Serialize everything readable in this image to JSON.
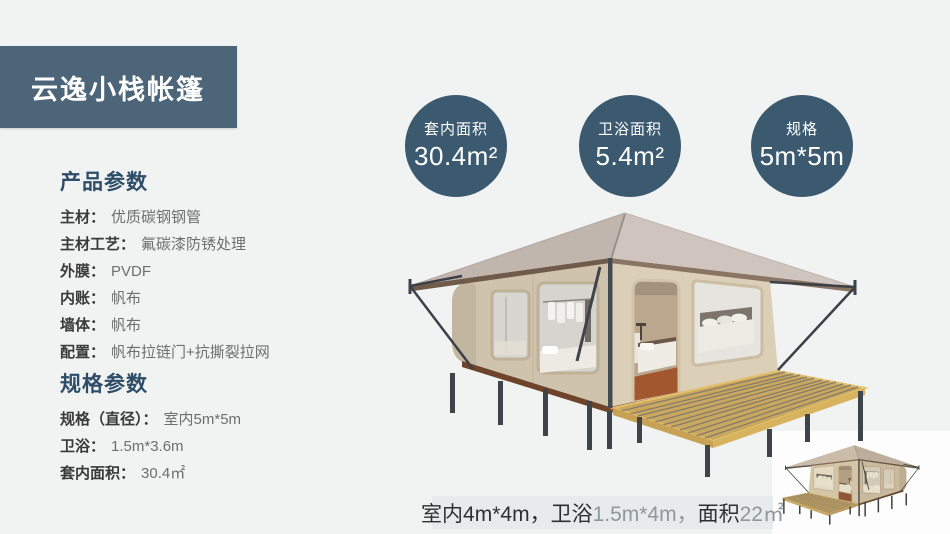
{
  "title": "云逸小栈帐篷",
  "colors": {
    "banner_bg": "#4d6579",
    "stat_circle_bg": "#3b5a70",
    "heading_text": "#2e4d68",
    "page_bg": "#f1f2f2"
  },
  "sections": [
    {
      "heading": "产品参数",
      "items": [
        {
          "label": "主材：",
          "value": "优质碳钢钢管"
        },
        {
          "label": "主材工艺：",
          "value": "氟碳漆防锈处理"
        },
        {
          "label": "外膜：",
          "value": "PVDF"
        },
        {
          "label": "内账：",
          "value": "帆布"
        },
        {
          "label": "墙体：",
          "value": "帆布"
        },
        {
          "label": "配置：",
          "value": "帆布拉链门+抗撕裂拉网"
        }
      ]
    },
    {
      "heading": "规格参数",
      "items": [
        {
          "label": "规格（直径）：",
          "value": "室内5m*5m"
        },
        {
          "label": "卫浴：",
          "value": "1.5m*3.6m"
        },
        {
          "label": "套内面积：",
          "value": "30.4㎡"
        }
      ]
    }
  ],
  "stats": [
    {
      "label": "套内面积",
      "value": "30.4m²"
    },
    {
      "label": "卫浴面积",
      "value": "5.4m²"
    },
    {
      "label": "规格",
      "value": "5m*5m"
    }
  ],
  "caption": {
    "segments": [
      {
        "text": "室内4m*4m，"
      },
      {
        "text": "卫浴"
      },
      {
        "text": "1.5m*4m，"
      },
      {
        "text": "面积"
      },
      {
        "text": "22㎡"
      }
    ]
  }
}
